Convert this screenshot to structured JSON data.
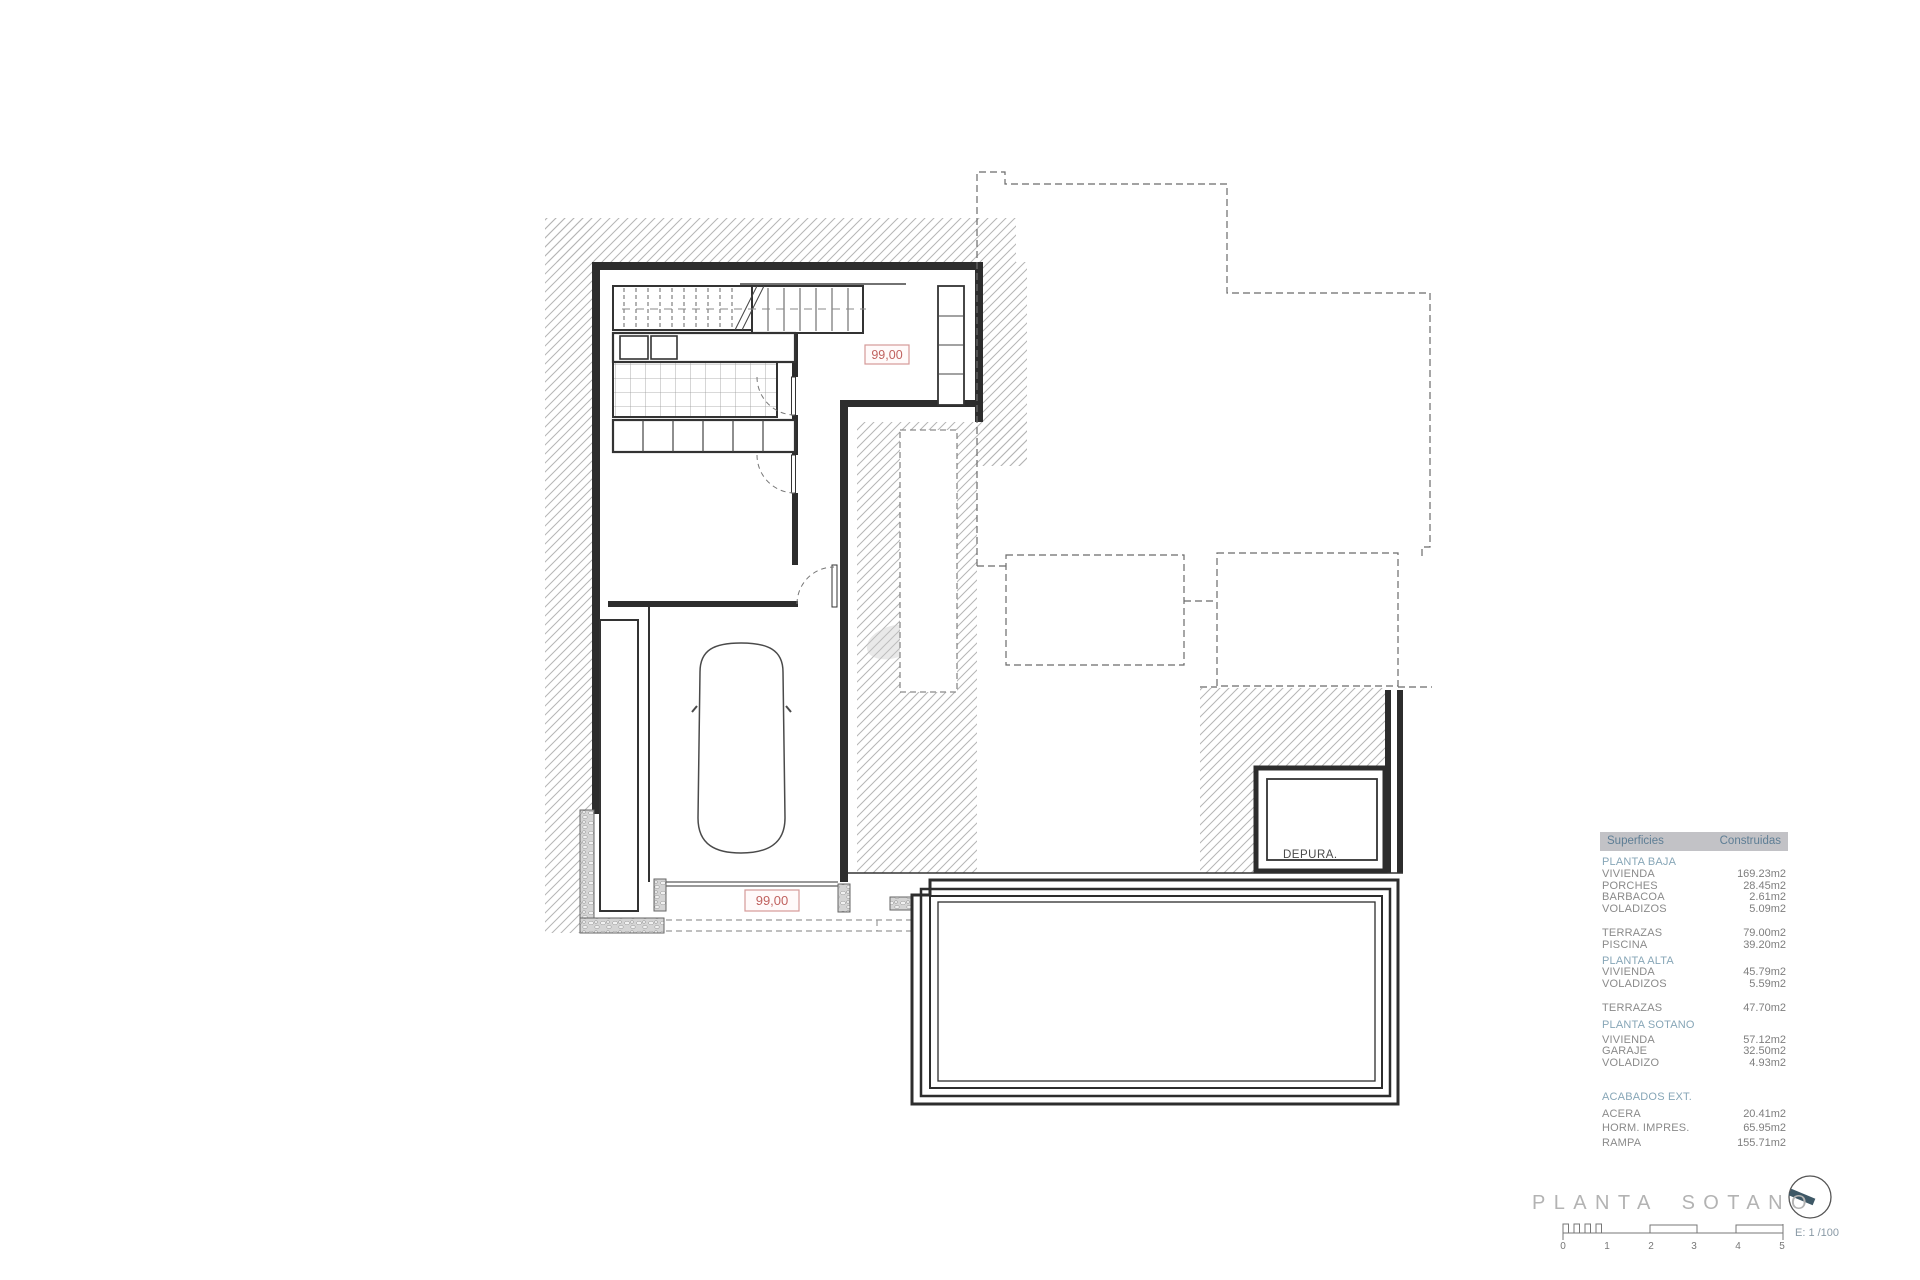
{
  "plan": {
    "room_labels": {
      "depura": "DEPURA."
    },
    "level_markers": {
      "upper": "99,00",
      "lower": "99,00"
    }
  },
  "areas_table": {
    "header": {
      "surfaces": "Superficies",
      "built": "Construidas"
    },
    "rows": [
      {
        "label": "PLANTA BAJA",
        "value": "",
        "kind": "section"
      },
      {
        "label": "VIVIENDA",
        "value": "169.23m2",
        "kind": "item"
      },
      {
        "label": "PORCHES",
        "value": "28.45m2",
        "kind": "item"
      },
      {
        "label": "BARBACOA",
        "value": "2.61m2",
        "kind": "item"
      },
      {
        "label": "VOLADIZOS",
        "value": "5.09m2",
        "kind": "item"
      },
      {
        "label": "TERRAZAS",
        "value": "79.00m2",
        "kind": "item"
      },
      {
        "label": "PISCINA",
        "value": "39.20m2",
        "kind": "item"
      },
      {
        "label": "PLANTA ALTA",
        "value": "",
        "kind": "section"
      },
      {
        "label": "VIVIENDA",
        "value": "45.79m2",
        "kind": "item"
      },
      {
        "label": "VOLADIZOS",
        "value": "5.59m2",
        "kind": "item"
      },
      {
        "label": "TERRAZAS",
        "value": "47.70m2",
        "kind": "item"
      },
      {
        "label": "PLANTA SOTANO",
        "value": "",
        "kind": "section"
      },
      {
        "label": "VIVIENDA",
        "value": "57.12m2",
        "kind": "item"
      },
      {
        "label": "GARAJE",
        "value": "32.50m2",
        "kind": "item"
      },
      {
        "label": "VOLADIZO",
        "value": "4.93m2",
        "kind": "item"
      },
      {
        "label": "ACABADOS EXT.",
        "value": "",
        "kind": "section"
      },
      {
        "label": "ACERA",
        "value": "20.41m2",
        "kind": "item"
      },
      {
        "label": "HORM. IMPRES.",
        "value": "65.95m2",
        "kind": "item"
      },
      {
        "label": "RAMPA",
        "value": "155.71m2",
        "kind": "item"
      }
    ]
  },
  "title_block": {
    "title": "PLANTA SOTANO",
    "scale_label": "E: 1 /100",
    "scale_ticks": [
      "0",
      "1",
      "2",
      "3",
      "4",
      "5"
    ]
  },
  "colors": {
    "marker_red": "#c0625f",
    "marker_border": "#d49a98",
    "table_header_bg": "#c2c2c6",
    "table_accent": "#87a6b7",
    "header_text": "#5e7e95",
    "title_gray": "#b3b3b3",
    "compass_needle": "#3e5866",
    "hatch_gray": "#b5b5b5",
    "wall_dark": "#2d2d2d"
  }
}
